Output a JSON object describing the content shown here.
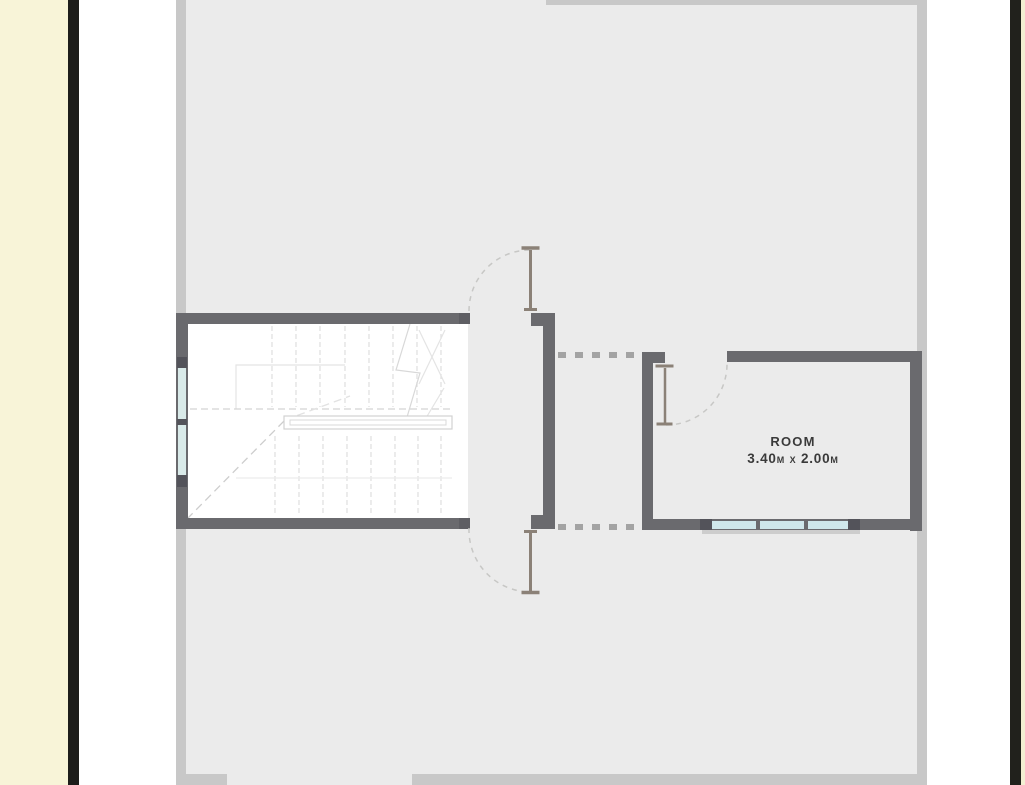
{
  "document": {
    "type": "architectural floor plan (upper floor / stair level)",
    "page_edges": {
      "left_margin": "cream strip + black rule",
      "right_margin": "black rule + cream strip"
    }
  },
  "room": {
    "name": "ROOM",
    "dimensions": "3.40m x 2.00m"
  },
  "palette": {
    "page_cream": "#f8f4d8",
    "page_rule_black": "#1d1d1b",
    "paper_white": "#ffffff",
    "plan_outer_border": "#c8c8c8",
    "floor_fill": "#ebebeb",
    "wall_gray": "#6a6a6e",
    "wall_cap_dark": "#53535a",
    "window_pane_blue": "#d2e7ea",
    "opening_dash_gray": "#a3a3a3",
    "door_leaf_brown": "#8b8177",
    "swing_arc_gray": "#c7c7c5",
    "stair_line_faint": "#dcdcdc",
    "label_text": "#3a3a3a"
  },
  "plan_elements": {
    "staircase": "white stairwell with treads, handrail and dashed break line",
    "doors": [
      "hall door swinging up",
      "hall door swinging down",
      "room door swinging into room"
    ],
    "openings": "dashed wall openings between hall and room",
    "windows": [
      "two panes on stair left wall",
      "three panes on room bottom wall"
    ]
  }
}
